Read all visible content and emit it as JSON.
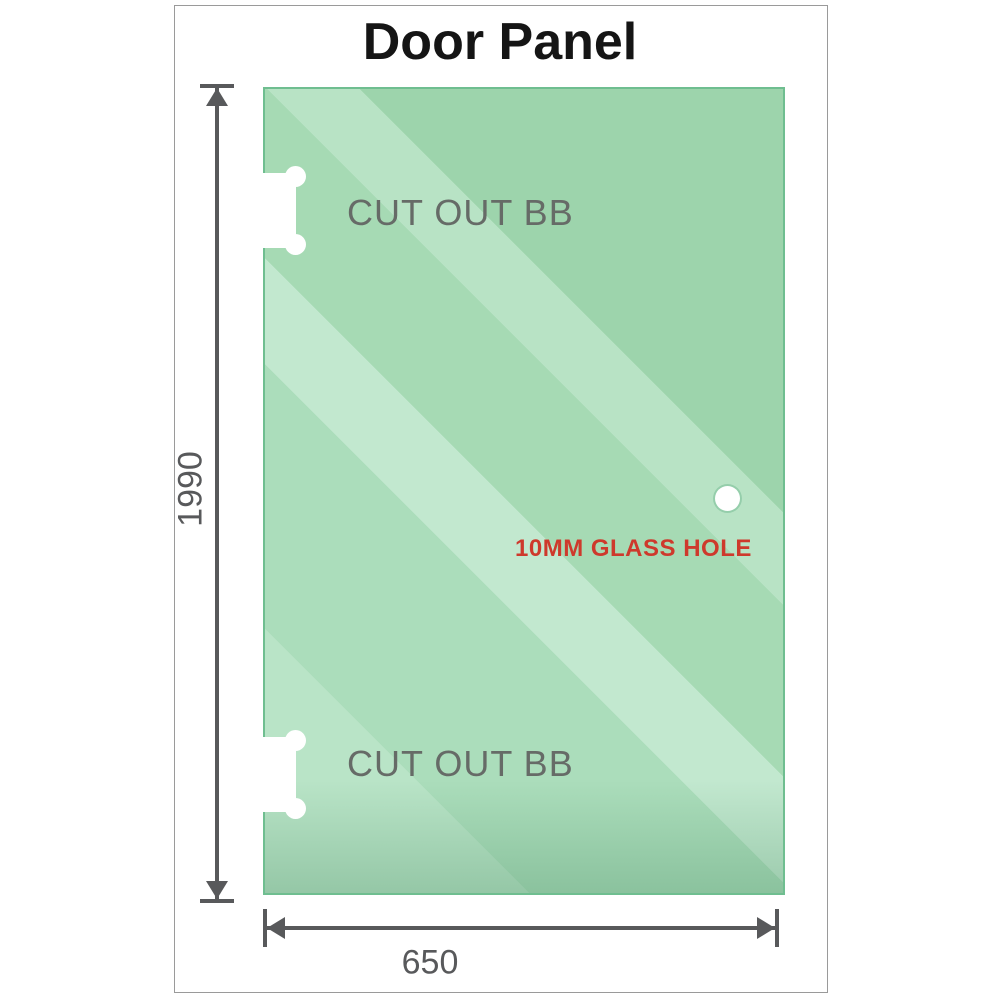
{
  "page": {
    "title": "Door Panel"
  },
  "panel": {
    "top_cutout_label": "CUT OUT BB",
    "bottom_cutout_label": "CUT OUT BB",
    "glass_hole_label": "10MM GLASS HOLE"
  },
  "dimensions": {
    "height_value": "1990",
    "width_value": "650"
  },
  "colors": {
    "glass_base": "#a6dab4",
    "glass_light": "#c2e8cf",
    "glass_border": "#6fbe90",
    "dimension_line": "#58595b",
    "cutout_text": "#666b67",
    "hole_text": "#ce392c",
    "frame_border": "#9a9a9a",
    "title_text": "#151515"
  }
}
